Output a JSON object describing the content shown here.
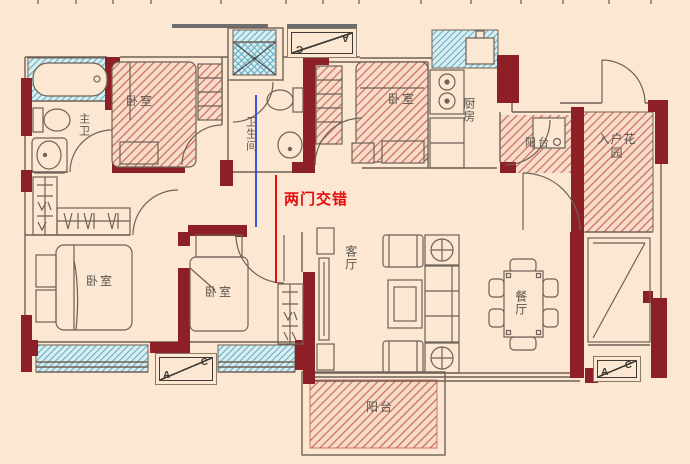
{
  "plan": {
    "annotation_text": "两门交错",
    "rooms": {
      "master_bath": "主卫",
      "bedroom_top_left": "卧室",
      "bathroom": "卫生间",
      "bedroom_top_middle": "卧室",
      "kitchen": "厨房",
      "service_balcony": "阳台",
      "entry_garden": "入户花园",
      "bedroom_bottom_left": "卧室",
      "bedroom_bottom_middle": "卧室",
      "living_room": "客厅",
      "dining_room": "餐厅",
      "main_balcony": "阳台"
    },
    "ac_unit": {
      "letter_a": "A",
      "letter_c": "C"
    },
    "colors": {
      "background": "#fbe7d2",
      "wall": "#8c2026",
      "red_hatch": "#cb6a59",
      "blue_hatch": "#66aec3",
      "annotation_red": "#e60d0d",
      "annotation_blue": "#3a53e0",
      "outline": "#6f6156"
    }
  }
}
